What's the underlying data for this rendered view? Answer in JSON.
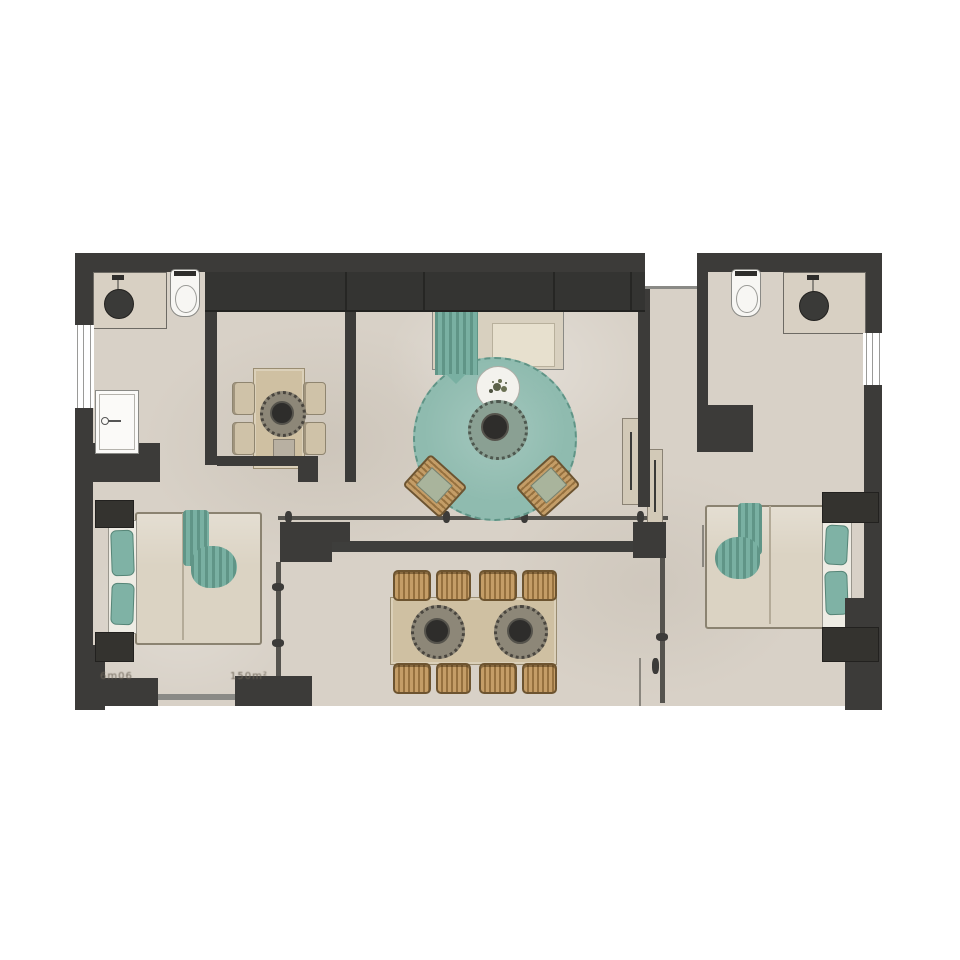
{
  "plan": {
    "type": "apartment-floor-plan",
    "labels": {
      "dim_left": "6m06",
      "dim_right": "150m²"
    },
    "palette": {
      "wall": "#3c3b39",
      "floor": "#d8d1c7",
      "teal_accent": "#8fbbaf",
      "wood": "#cfc0a2",
      "wicker": "#c49d67",
      "fixture_white": "#f7f6f3"
    },
    "rooms": [
      {
        "name": "bathroom-left",
        "furniture": [
          "vanity with round sink",
          "toilet",
          "shower"
        ]
      },
      {
        "name": "kitchen-nook",
        "furniture": [
          "rectangular table",
          "4 chairs",
          "round centerpiece",
          "stool"
        ]
      },
      {
        "name": "living-room",
        "furniture": [
          "sofa with teal throw",
          "round teal rug",
          "round coffee table",
          "side table with plant",
          "2 rattan armchairs",
          "closet row"
        ]
      },
      {
        "name": "corridor",
        "furniture": [
          "2 sliding door panels"
        ]
      },
      {
        "name": "bathroom-right",
        "furniture": [
          "vanity with round sink",
          "toilet"
        ]
      },
      {
        "name": "bedroom-left",
        "furniture": [
          "double bed",
          "teal throw",
          "2 nightstands",
          "window"
        ]
      },
      {
        "name": "bedroom-right",
        "furniture": [
          "double bed",
          "teal throw",
          "2 nightstands"
        ]
      },
      {
        "name": "terrace",
        "furniture": [
          "dining table",
          "8 rattan chairs",
          "2 centerpieces",
          "pergola posts",
          "railings"
        ]
      }
    ]
  }
}
